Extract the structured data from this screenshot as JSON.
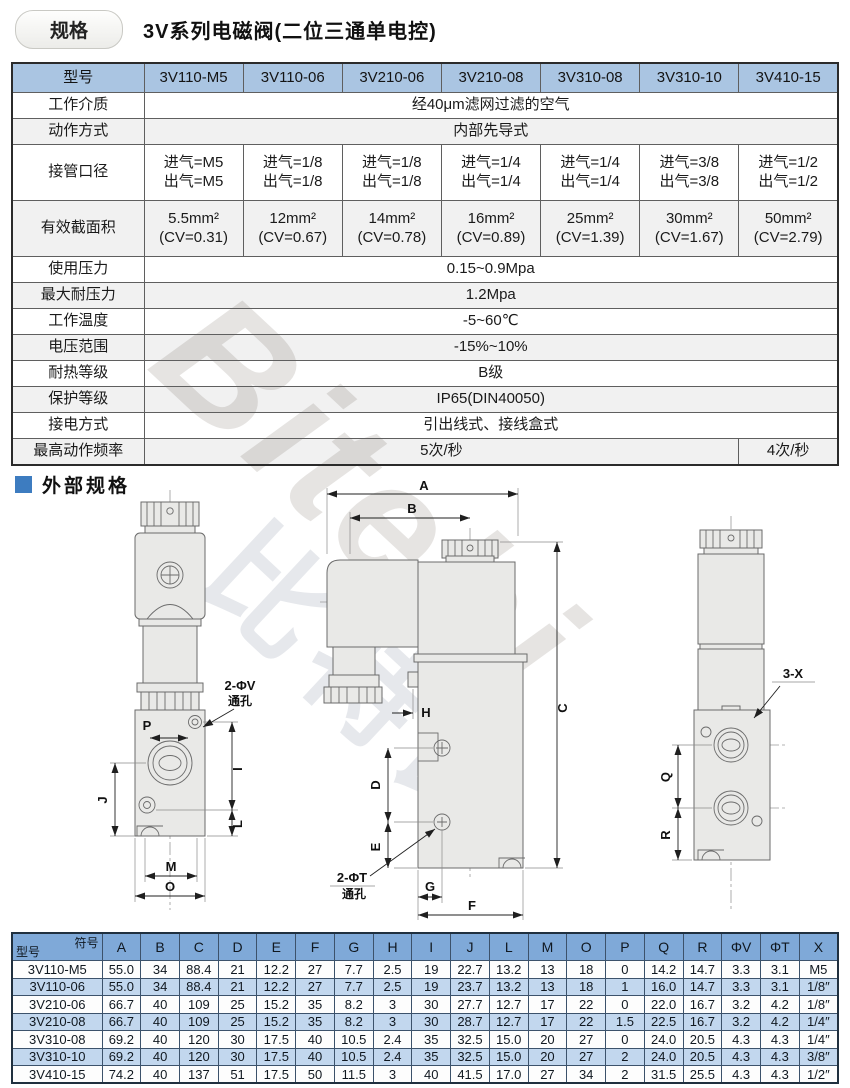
{
  "page": {
    "badge": "规格",
    "title": "3V系列电磁阀(二位三通单电控)",
    "section2_title": "外部规格",
    "watermark_latin": "Bitebi",
    "watermark_cjk": "比特比"
  },
  "colors": {
    "accent_blue": "#3d7cc0",
    "spec_header_blue": "#aac5e2",
    "dim_header_blue": "#7fa9d8",
    "dim_row_blue": "#c2d7ee"
  },
  "spec_table": {
    "header": {
      "label": "型号",
      "models": [
        "3V110-M5",
        "3V110-06",
        "3V210-06",
        "3V210-08",
        "3V310-08",
        "3V310-10",
        "3V410-15"
      ]
    },
    "rows": [
      {
        "label": "工作介质",
        "type": "span",
        "value": "经40μm滤网过滤的空气"
      },
      {
        "label": "动作方式",
        "type": "span",
        "value": "内部先导式"
      },
      {
        "label": "接管口径",
        "type": "cells",
        "values": [
          "进气=M5\n出气=M5",
          "进气=1/8\n出气=1/8",
          "进气=1/8\n出气=1/8",
          "进气=1/4\n出气=1/4",
          "进气=1/4\n出气=1/4",
          "进气=3/8\n出气=3/8",
          "进气=1/2\n出气=1/2"
        ]
      },
      {
        "label": "有效截面积",
        "type": "cells",
        "values": [
          "5.5mm²\n(CV=0.31)",
          "12mm²\n(CV=0.67)",
          "14mm²\n(CV=0.78)",
          "16mm²\n(CV=0.89)",
          "25mm²\n(CV=1.39)",
          "30mm²\n(CV=1.67)",
          "50mm²\n(CV=2.79)"
        ]
      },
      {
        "label": "使用压力",
        "type": "span",
        "value": "0.15~0.9Mpa"
      },
      {
        "label": "最大耐压力",
        "type": "span",
        "value": "1.2Mpa"
      },
      {
        "label": "工作温度",
        "type": "span",
        "value": "-5~60℃"
      },
      {
        "label": "电压范围",
        "type": "span",
        "value": "-15%~10%"
      },
      {
        "label": "耐热等级",
        "type": "span",
        "value": "B级"
      },
      {
        "label": "保护等级",
        "type": "span",
        "value": "IP65(DIN40050)"
      },
      {
        "label": "接电方式",
        "type": "span",
        "value": "引出线式、接线盒式"
      },
      {
        "label": "最高动作频率",
        "type": "split",
        "value": "5次/秒",
        "value2": "4次/秒"
      }
    ]
  },
  "drawing": {
    "dims": {
      "A": "A",
      "B": "B",
      "C": "C",
      "D": "D",
      "E": "E",
      "F": "F",
      "G": "G",
      "H": "H",
      "I": "I",
      "J": "J",
      "L": "L",
      "M": "M",
      "O": "O",
      "P": "P",
      "Q": "Q",
      "R": "R"
    },
    "labels": {
      "v_hole": "2-ΦV",
      "t_hole": "2-ΦT",
      "through": "通孔",
      "x3": "3-X"
    }
  },
  "dim_table": {
    "corner_top": "符号",
    "corner_bottom": "型号",
    "columns": [
      "A",
      "B",
      "C",
      "D",
      "E",
      "F",
      "G",
      "H",
      "I",
      "J",
      "L",
      "M",
      "O",
      "P",
      "Q",
      "R",
      "ΦV",
      "ΦT",
      "X"
    ],
    "rows": [
      {
        "model": "3V110-M5",
        "values": [
          "55.0",
          "34",
          "88.4",
          "21",
          "12.2",
          "27",
          "7.7",
          "2.5",
          "19",
          "22.7",
          "13.2",
          "13",
          "18",
          "0",
          "14.2",
          "14.7",
          "3.3",
          "3.1",
          "M5"
        ]
      },
      {
        "model": "3V110-06",
        "values": [
          "55.0",
          "34",
          "88.4",
          "21",
          "12.2",
          "27",
          "7.7",
          "2.5",
          "19",
          "23.7",
          "13.2",
          "13",
          "18",
          "1",
          "16.0",
          "14.7",
          "3.3",
          "3.1",
          "1/8″"
        ]
      },
      {
        "model": "3V210-06",
        "values": [
          "66.7",
          "40",
          "109",
          "25",
          "15.2",
          "35",
          "8.2",
          "3",
          "30",
          "27.7",
          "12.7",
          "17",
          "22",
          "0",
          "22.0",
          "16.7",
          "3.2",
          "4.2",
          "1/8″"
        ]
      },
      {
        "model": "3V210-08",
        "values": [
          "66.7",
          "40",
          "109",
          "25",
          "15.2",
          "35",
          "8.2",
          "3",
          "30",
          "28.7",
          "12.7",
          "17",
          "22",
          "1.5",
          "22.5",
          "16.7",
          "3.2",
          "4.2",
          "1/4″"
        ]
      },
      {
        "model": "3V310-08",
        "values": [
          "69.2",
          "40",
          "120",
          "30",
          "17.5",
          "40",
          "10.5",
          "2.4",
          "35",
          "32.5",
          "15.0",
          "20",
          "27",
          "0",
          "24.0",
          "20.5",
          "4.3",
          "4.3",
          "1/4″"
        ]
      },
      {
        "model": "3V310-10",
        "values": [
          "69.2",
          "40",
          "120",
          "30",
          "17.5",
          "40",
          "10.5",
          "2.4",
          "35",
          "32.5",
          "15.0",
          "20",
          "27",
          "2",
          "24.0",
          "20.5",
          "4.3",
          "4.3",
          "3/8″"
        ]
      },
      {
        "model": "3V410-15",
        "values": [
          "74.2",
          "40",
          "137",
          "51",
          "17.5",
          "50",
          "11.5",
          "3",
          "40",
          "41.5",
          "17.0",
          "27",
          "34",
          "2",
          "31.5",
          "25.5",
          "4.3",
          "4.3",
          "1/2″"
        ]
      }
    ]
  }
}
